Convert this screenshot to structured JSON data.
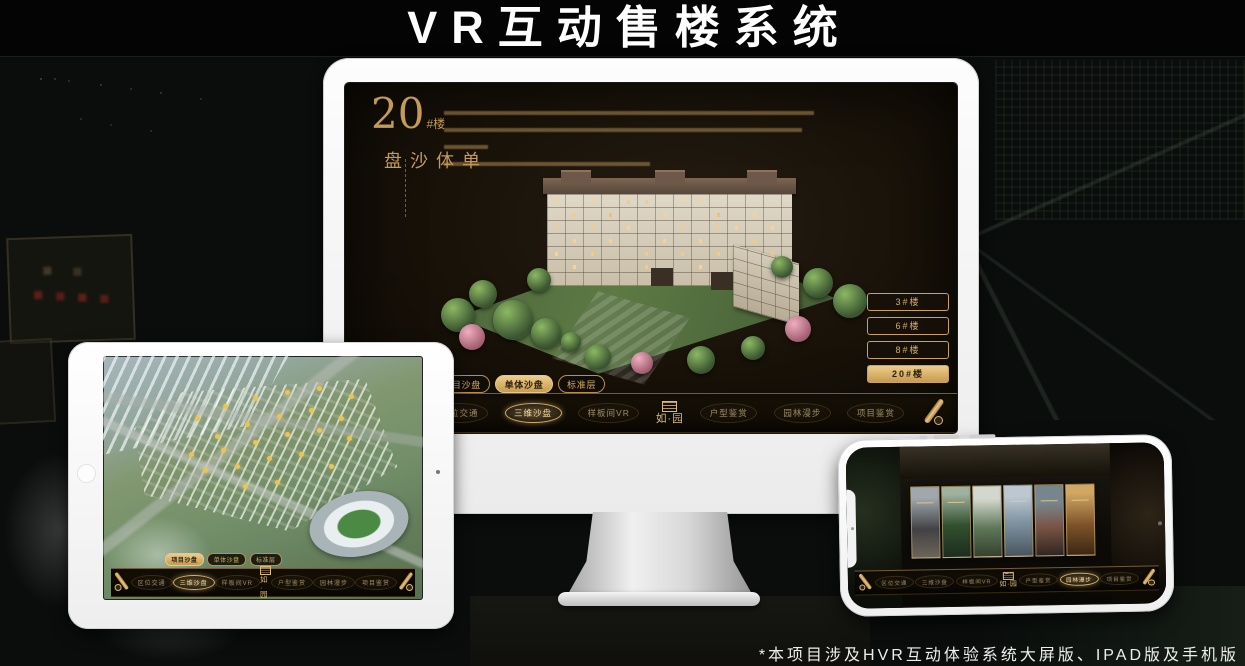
{
  "page": {
    "title": "VR互动售楼系统",
    "footnote": "*本项目涉及HVR互动体验系统大屏版、IPAD版及手机版"
  },
  "colors": {
    "gold_accent": "#d4af6a",
    "gold_text": "#c59a58",
    "screen_background": "#171108",
    "active_pill_background": "#c89a4e"
  },
  "monitor": {
    "headline": {
      "number": "20",
      "suffix": "#楼",
      "vertical": "单体沙盘"
    },
    "building_buttons": [
      {
        "label": "3#楼"
      },
      {
        "label": "6#楼"
      },
      {
        "label": "8#楼"
      },
      {
        "label": "20#楼"
      }
    ],
    "sub_tabs": [
      {
        "label": "项目沙盘"
      },
      {
        "label": "单体沙盘"
      },
      {
        "label": "标准层"
      }
    ],
    "nav": {
      "logo": "如·园",
      "items": [
        {
          "label": "区位交通"
        },
        {
          "label": "三维沙盘"
        },
        {
          "label": "样板间VR"
        },
        {
          "label": "户型鉴赏"
        },
        {
          "label": "园林漫步"
        },
        {
          "label": "项目鉴赏"
        }
      ]
    }
  },
  "tablet": {
    "sub_tabs": [
      {
        "label": "项目沙盘"
      },
      {
        "label": "单体沙盘"
      },
      {
        "label": "标准层"
      }
    ],
    "nav": {
      "logo": "如·园",
      "items": [
        {
          "label": "区位交通"
        },
        {
          "label": "三维沙盘"
        },
        {
          "label": "样板间VR"
        },
        {
          "label": "户型鉴赏"
        },
        {
          "label": "园林漫步"
        },
        {
          "label": "项目鉴赏"
        }
      ]
    }
  },
  "phone": {
    "nav": {
      "logo": "如·园",
      "items": [
        {
          "label": "区位交通"
        },
        {
          "label": "三维沙盘"
        },
        {
          "label": "样板间VR"
        },
        {
          "label": "户型鉴赏"
        },
        {
          "label": "园林漫步"
        },
        {
          "label": "项目鉴赏"
        }
      ]
    }
  }
}
